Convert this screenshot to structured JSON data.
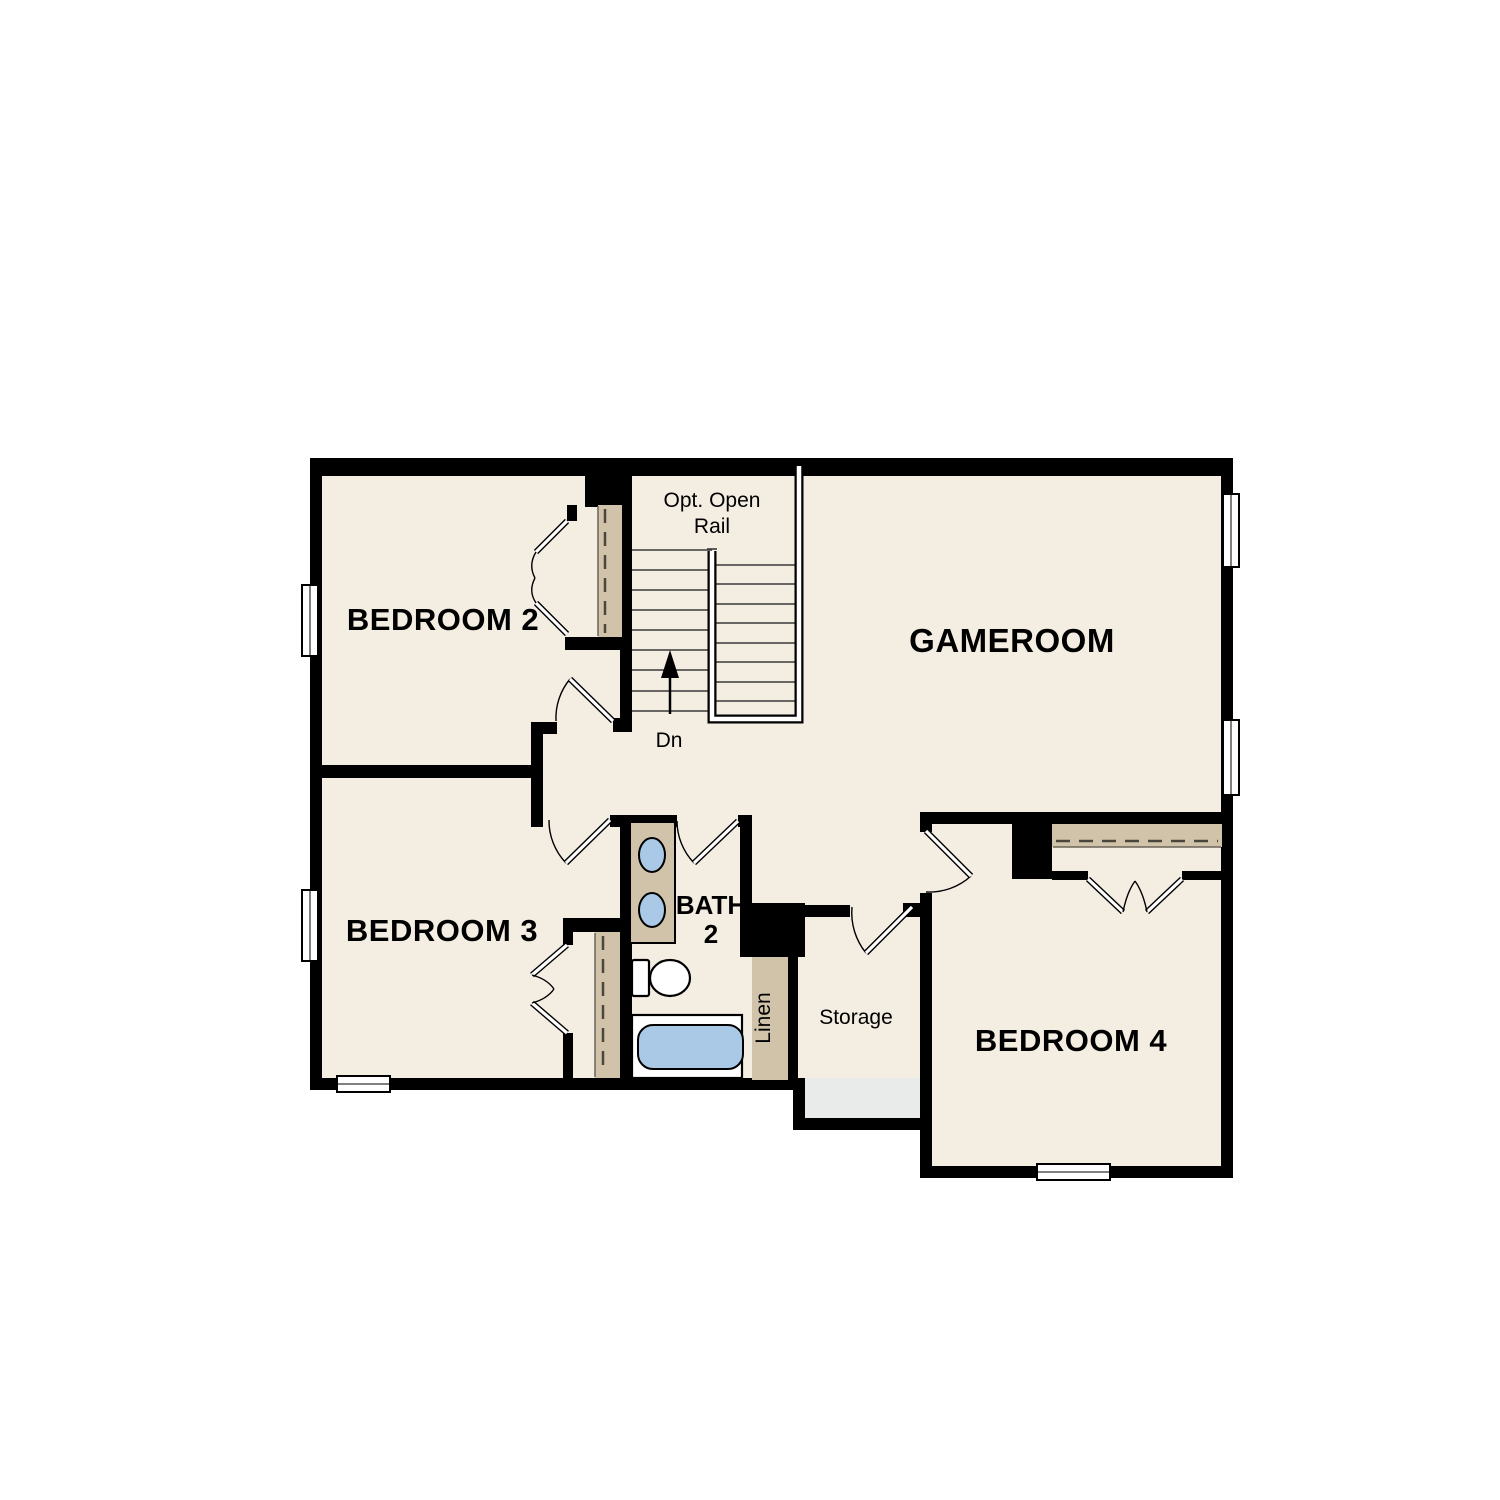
{
  "title": "Second Floor Plan",
  "colors": {
    "floor": "#f4ede2",
    "wall": "#000000",
    "closet": "#d1c3a9",
    "fixture": "#a9c9e7",
    "grayfloor": "#e9eaea",
    "background": "#ffffff"
  },
  "rooms": {
    "bedroom2": {
      "label": "BEDROOM 2"
    },
    "bedroom3": {
      "label": "BEDROOM 3"
    },
    "bedroom4": {
      "label": "BEDROOM 4"
    },
    "gameroom": {
      "label": "GAMEROOM"
    },
    "bath2": {
      "label_line1": "BATH",
      "label_line2": "2"
    },
    "storage": {
      "label": "Storage"
    },
    "linen": {
      "label": "Linen"
    }
  },
  "stairs": {
    "note_line1": "Opt. Open",
    "note_line2": "Rail",
    "direction": "Dn"
  }
}
